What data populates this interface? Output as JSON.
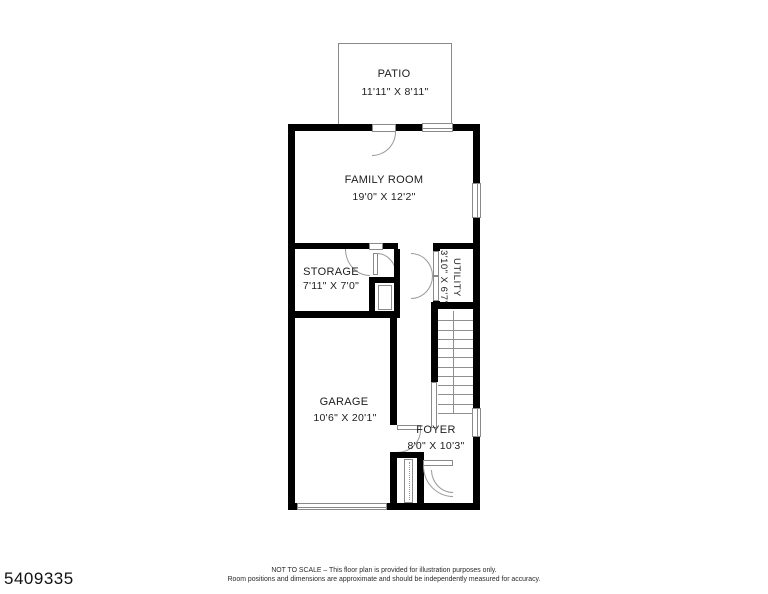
{
  "listing_id": "5409335",
  "rooms": {
    "patio": {
      "name": "PATIO",
      "dims": "11'11\" X 8'11\""
    },
    "family_room": {
      "name": "FAMILY ROOM",
      "dims": "19'0\" X 12'2\""
    },
    "storage": {
      "name": "STORAGE",
      "dims": "7'11\" X 7'0\""
    },
    "utility": {
      "name": "UTILITY",
      "dims": "3'10\" X 6'7\""
    },
    "garage": {
      "name": "GARAGE",
      "dims": "10'6\" X 20'1\""
    },
    "foyer": {
      "name": "FOYER",
      "dims": "8'0\" X 10'3\""
    }
  },
  "stairs": {
    "tread_count": 11
  },
  "disclaimer": {
    "line1": "NOT TO SCALE – This floor plan is provided for illustration purposes only.",
    "line2": "Room positions and dimensions are approximate and should be independently measured for accuracy."
  },
  "colors": {
    "wall": "#000000",
    "thin_line": "#8a8a8a",
    "text": "#1a1a1a",
    "background": "#ffffff"
  }
}
